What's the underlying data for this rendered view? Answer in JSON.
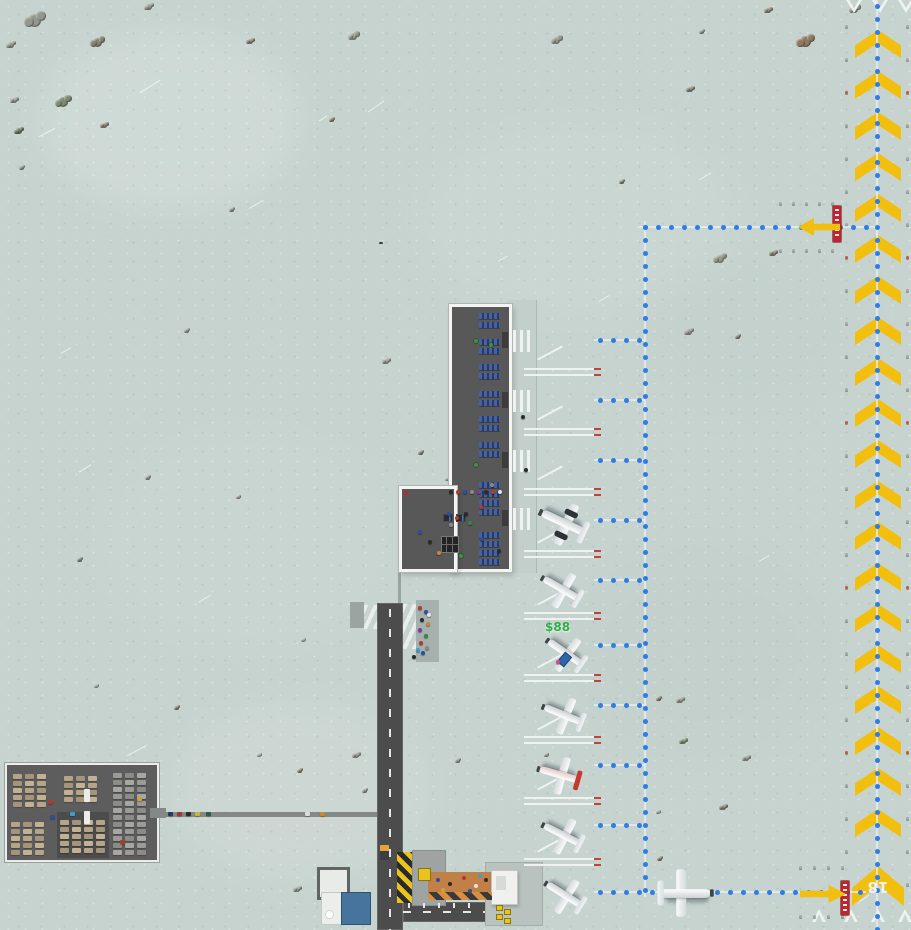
{
  "texts": {
    "money": "$88",
    "runway_number": "18"
  },
  "patches": [
    [
      40,
      30,
      260,
      180,
      "#d6e0dc",
      0.55
    ],
    [
      420,
      120,
      320,
      200,
      "#cdd9d5",
      0.5
    ],
    [
      100,
      430,
      300,
      220,
      "#ccd8d4",
      0.45
    ],
    [
      560,
      540,
      280,
      220,
      "#c2cfca",
      0.5
    ],
    [
      170,
      700,
      260,
      180,
      "#d2dcd8",
      0.5
    ],
    [
      640,
      250,
      220,
      160,
      "#c3d0cc",
      0.45
    ]
  ],
  "streaks": [
    [
      138,
      86,
      24,
      -32
    ],
    [
      38,
      132,
      18,
      -28
    ],
    [
      366,
      106,
      20,
      -35
    ],
    [
      248,
      204,
      16,
      -30
    ],
    [
      698,
      176,
      14,
      -30
    ],
    [
      126,
      750,
      22,
      -28
    ],
    [
      78,
      468,
      14,
      -32
    ],
    [
      598,
      298,
      12,
      -30
    ],
    [
      198,
      598,
      14,
      -30
    ],
    [
      758,
      558,
      12,
      -30
    ],
    [
      318,
      118,
      10,
      -32
    ],
    [
      638,
      478,
      10,
      -30
    ],
    [
      858,
      898,
      12,
      -35
    ],
    [
      498,
      258,
      10,
      -30
    ],
    [
      60,
      350,
      12,
      -30
    ]
  ],
  "vegetation": {
    "colors": [
      "#94978e",
      "#878272",
      "#7d8a70",
      "#a4a096",
      "#68765f",
      "#8d7a5f"
    ],
    "items": [
      [
        28,
        14,
        13,
        0
      ],
      [
        8,
        42,
        6,
        0
      ],
      [
        93,
        38,
        9,
        1
      ],
      [
        58,
        97,
        10,
        2
      ],
      [
        12,
        98,
        5,
        0
      ],
      [
        16,
        128,
        6,
        4
      ],
      [
        102,
        123,
        5,
        1
      ],
      [
        146,
        4,
        6,
        0
      ],
      [
        248,
        39,
        5,
        1
      ],
      [
        350,
        33,
        7,
        0
      ],
      [
        553,
        37,
        7,
        0
      ],
      [
        800,
        36,
        11,
        5
      ],
      [
        851,
        6,
        7,
        0
      ],
      [
        688,
        87,
        5,
        1
      ],
      [
        20,
        166,
        4,
        0
      ],
      [
        716,
        255,
        8,
        0
      ],
      [
        771,
        251,
        5,
        1
      ],
      [
        686,
        329,
        6,
        0
      ],
      [
        736,
        335,
        4,
        1
      ],
      [
        185,
        329,
        4,
        0
      ],
      [
        384,
        359,
        5,
        0
      ],
      [
        419,
        451,
        4,
        1
      ],
      [
        446,
        478,
        3,
        0
      ],
      [
        237,
        496,
        3,
        1
      ],
      [
        146,
        476,
        4,
        0
      ],
      [
        78,
        558,
        4,
        1
      ],
      [
        302,
        639,
        3,
        0
      ],
      [
        678,
        698,
        5,
        0
      ],
      [
        657,
        697,
        4,
        1
      ],
      [
        681,
        739,
        5,
        2
      ],
      [
        744,
        756,
        5,
        0
      ],
      [
        721,
        805,
        5,
        1
      ],
      [
        657,
        811,
        3,
        0
      ],
      [
        354,
        753,
        5,
        0
      ],
      [
        298,
        769,
        4,
        1
      ],
      [
        363,
        789,
        4,
        0
      ],
      [
        295,
        887,
        5,
        0
      ],
      [
        658,
        857,
        4,
        1
      ],
      [
        456,
        759,
        4,
        0
      ],
      [
        545,
        754,
        3,
        1
      ],
      [
        258,
        754,
        3,
        0
      ],
      [
        175,
        706,
        4,
        1
      ],
      [
        95,
        685,
        3,
        0
      ],
      [
        620,
        180,
        4,
        1
      ],
      [
        230,
        208,
        4,
        0
      ],
      [
        330,
        118,
        4,
        1
      ],
      [
        700,
        30,
        4,
        0
      ],
      [
        766,
        8,
        5,
        1
      ]
    ]
  },
  "runway": {
    "chevron": {
      "cx": 878,
      "w": 46,
      "h": 28,
      "y0": 30,
      "step": 41,
      "count": 20
    },
    "big_chevron": {
      "x": 852,
      "y": 866,
      "w": 52,
      "h": 40
    },
    "threshold_top": {
      "xs": [
        846,
        872,
        898
      ],
      "y": 0,
      "w": 16,
      "h": 13
    },
    "threshold_bottom": {
      "xs": [
        812,
        844,
        871,
        898
      ],
      "y": 909,
      "w": 14,
      "h": 13
    },
    "edge_light_cols": [
      {
        "x": 845,
        "y0": 25,
        "dy": 33,
        "count": 27
      },
      {
        "x": 906,
        "y0": 25,
        "dy": 33,
        "count": 27
      }
    ],
    "hold_light_rows": [
      {
        "x0": 779,
        "y": 202,
        "dx": 13,
        "count": 5
      },
      {
        "x0": 779,
        "y": 249,
        "dx": 13,
        "count": 5
      },
      {
        "x0": 799,
        "y": 866,
        "dx": 14,
        "count": 4
      },
      {
        "x0": 799,
        "y": 915,
        "dx": 14,
        "count": 4
      }
    ],
    "hold_signs": [
      {
        "x": 833,
        "y": 206,
        "w": 8,
        "h": 36
      },
      {
        "x": 841,
        "y": 881,
        "w": 8,
        "h": 34
      }
    ],
    "arrows": [
      {
        "x": 798,
        "y": 218,
        "w": 42,
        "h": 18,
        "dir": "left"
      },
      {
        "x": 800,
        "y": 885,
        "w": 46,
        "h": 18,
        "dir": "right"
      }
    ]
  },
  "taxi": {
    "v_lines": [
      {
        "x": 877,
        "y0": 0,
        "y1": 930
      },
      {
        "x": 645,
        "y0": 221,
        "y1": 897
      }
    ],
    "h_lines": [
      {
        "y": 227,
        "x0": 639,
        "x1": 877
      },
      {
        "y": 892,
        "x0": 594,
        "x1": 866
      }
    ],
    "stub_ys": [
      340,
      400,
      460,
      520,
      580,
      645,
      705,
      765,
      825
    ],
    "stub_x0": 594,
    "stub_x1": 645
  },
  "stands": {
    "boundary_ys": [
      368,
      428,
      488,
      550,
      612,
      674,
      736,
      797,
      858
    ],
    "line_x0": 524,
    "line_w": 77,
    "diag_cys": [
      340,
      400,
      460,
      523,
      585,
      648,
      710,
      770,
      832
    ],
    "zebra_ys": [
      330,
      390,
      450,
      508
    ],
    "door_ys": [
      332,
      392,
      452,
      510
    ]
  },
  "terminal": {
    "seat_x": 479,
    "seat_w": 21,
    "seat_h": 6,
    "seat_ys": [
      313,
      322,
      339,
      348,
      364,
      373,
      391,
      400,
      416,
      425,
      442,
      451,
      482,
      491,
      500,
      509,
      532,
      541,
      550,
      559
    ],
    "plants": [
      [
        474,
        339
      ],
      [
        474,
        463
      ],
      [
        459,
        554
      ],
      [
        489,
        343
      ]
    ],
    "desks": [
      {
        "x": 443,
        "y": 514,
        "w": 10,
        "h": 8
      },
      {
        "x": 456,
        "y": 514,
        "w": 10,
        "h": 8
      }
    ]
  },
  "planes": [
    {
      "x": 540,
      "y": 500,
      "r": 205,
      "v": "twin",
      "s": 1.15
    },
    {
      "x": 538,
      "y": 566,
      "r": 210,
      "v": "plain",
      "s": 1
    },
    {
      "x": 542,
      "y": 630,
      "r": 215,
      "v": "plain",
      "s": 1
    },
    {
      "x": 540,
      "y": 692,
      "r": 202,
      "v": "plain",
      "s": 1
    },
    {
      "x": 536,
      "y": 752,
      "r": 196,
      "v": "red",
      "s": 1
    },
    {
      "x": 539,
      "y": 812,
      "r": 207,
      "v": "plain",
      "s": 1
    },
    {
      "x": 541,
      "y": 872,
      "r": 212,
      "v": "plain",
      "s": 1
    },
    {
      "x": 662,
      "y": 870,
      "r": 0,
      "v": "plain",
      "s": 1.25
    }
  ],
  "carts": [
    [
      560,
      653,
      40
    ]
  ],
  "people": {
    "colors": [
      "#2b2b2b",
      "#b23a2e",
      "#2e4d9e",
      "#8a8a8a",
      "#7a3f9e",
      "#2e8a4a",
      "#e3e3e0",
      "#c9853a",
      "#3aa0c9",
      "#d44a8a"
    ],
    "items": [
      [
        449,
        490,
        0
      ],
      [
        456,
        490,
        1
      ],
      [
        463,
        490,
        2
      ],
      [
        470,
        490,
        3
      ],
      [
        477,
        490,
        4
      ],
      [
        484,
        490,
        0
      ],
      [
        491,
        490,
        1
      ],
      [
        498,
        490,
        6
      ],
      [
        447,
        512,
        2
      ],
      [
        455,
        516,
        1
      ],
      [
        464,
        512,
        0
      ],
      [
        449,
        523,
        3
      ],
      [
        468,
        521,
        5
      ],
      [
        479,
        505,
        1
      ],
      [
        480,
        537,
        2
      ],
      [
        497,
        549,
        0
      ],
      [
        490,
        483,
        3
      ],
      [
        428,
        540,
        0
      ],
      [
        418,
        530,
        2
      ],
      [
        437,
        551,
        7
      ],
      [
        418,
        606,
        1
      ],
      [
        424,
        610,
        2
      ],
      [
        420,
        618,
        0
      ],
      [
        426,
        622,
        7
      ],
      [
        418,
        628,
        4
      ],
      [
        424,
        634,
        5
      ],
      [
        419,
        641,
        1
      ],
      [
        425,
        646,
        3
      ],
      [
        421,
        651,
        2
      ],
      [
        427,
        613,
        6
      ],
      [
        412,
        655,
        0
      ],
      [
        416,
        648,
        8
      ],
      [
        524,
        468,
        0
      ],
      [
        521,
        415,
        0
      ],
      [
        556,
        660,
        9
      ]
    ]
  },
  "parking": {
    "car_colors": [
      "#b5a488",
      "#9a9a96",
      "#8f8678",
      "#6a6a66"
    ],
    "car_w": 9,
    "car_h": 5,
    "blocks": [
      {
        "x0": 13,
        "y0": 774,
        "cols": 3,
        "rows": 5,
        "dx": 12,
        "dy": 7,
        "c": 0
      },
      {
        "x0": 64,
        "y0": 776,
        "cols": 3,
        "rows": 4,
        "dx": 12,
        "dy": 7,
        "c": 0
      },
      {
        "x0": 113,
        "y0": 773,
        "cols": 3,
        "rows": 12,
        "dx": 12,
        "dy": 7,
        "c": 1
      },
      {
        "x0": 11,
        "y0": 822,
        "cols": 3,
        "rows": 5,
        "dx": 12,
        "dy": 7,
        "c": 0
      },
      {
        "x0": 60,
        "y0": 820,
        "cols": 4,
        "rows": 5,
        "dx": 12,
        "dy": 7,
        "c": 0
      }
    ],
    "vans": [
      [
        84,
        789
      ],
      [
        84,
        811
      ]
    ],
    "misc": [
      [
        48,
        800,
        "#b03a2e"
      ],
      [
        50,
        815,
        "#2b4d9e"
      ],
      [
        137,
        797,
        "#caa23a"
      ],
      [
        70,
        812,
        "#3aa0c9"
      ],
      [
        120,
        840,
        "#b03a2e"
      ]
    ]
  },
  "access_road": {
    "car_colors": [
      "#223a5e",
      "#a03a2e",
      "#2b2b2b",
      "#c9b82e",
      "#2e5a46",
      "#d8dee0",
      "#c98a2e"
    ],
    "cars": [
      [
        168,
        0
      ],
      [
        177,
        1
      ],
      [
        186,
        2
      ],
      [
        195,
        3
      ],
      [
        206,
        4
      ],
      [
        305,
        5
      ],
      [
        320,
        6
      ]
    ]
  },
  "road_ticks": [
    [
      408,
      903
    ],
    [
      423,
      903
    ],
    [
      438,
      903
    ],
    [
      453,
      903
    ],
    [
      468,
      903
    ]
  ],
  "construction_dots": [
    [
      436,
      878,
      "#2b4d9e"
    ],
    [
      448,
      882,
      "#2b2b2b"
    ],
    [
      462,
      876,
      "#b03a2e"
    ],
    [
      474,
      884,
      "#e3e3e0"
    ],
    [
      484,
      878,
      "#2b2b2b"
    ],
    [
      441,
      888,
      "#caa23a"
    ],
    [
      468,
      889,
      "#2b4d9e"
    ],
    [
      478,
      874,
      "#3aa0c9"
    ]
  ],
  "fuel_pumps": [
    [
      497,
      906
    ],
    [
      505,
      910
    ],
    [
      497,
      915
    ],
    [
      505,
      919
    ]
  ]
}
